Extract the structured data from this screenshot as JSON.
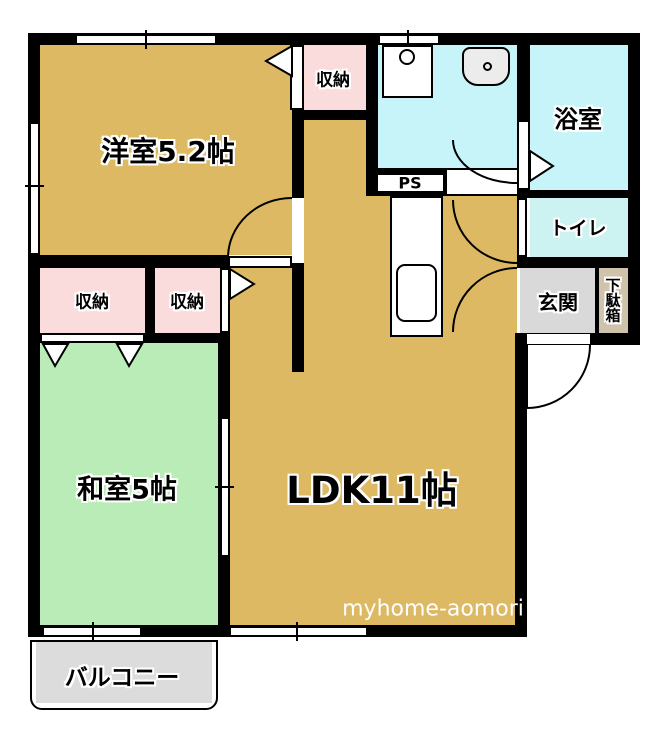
{
  "rooms": {
    "western_room": {
      "label": "洋室5.2帖"
    },
    "closet_top": {
      "label": "収納"
    },
    "washroom": {
      "label": ""
    },
    "bathroom": {
      "label": "浴室"
    },
    "toilet": {
      "label": "トイレ"
    },
    "pipe_space": {
      "label": "PS"
    },
    "closet_left": {
      "label": "収納"
    },
    "closet_right": {
      "label": "収納"
    },
    "japanese_room": {
      "label": "和室5帖"
    },
    "ldk": {
      "label": "LDK11帖"
    },
    "entrance": {
      "label": "玄関"
    },
    "shoe_cabinet": {
      "label": "下駄箱"
    },
    "balcony": {
      "label": "バルコニー"
    }
  },
  "watermark": "myhome-aomori",
  "fixtures": [
    "washing-machine-pan",
    "wash-basin",
    "kitchen-counter",
    "kitchen-sink"
  ],
  "colors": {
    "wall": "#000000",
    "western_room_floor": "#ddb963",
    "ldk_floor": "#ddb963",
    "japanese_room_floor": "#b9ecb6",
    "closet_floor": "#fbdcdc",
    "washroom_floor": "#c6f4f9",
    "bathroom_floor": "#c6f4f9",
    "toilet_floor": "#cdf2f2",
    "entrance_floor": "#d9d9d9",
    "shoe_cabinet_floor": "#cfc3ab",
    "balcony_floor": "#dcdcdc",
    "watermark_text": "#ffffff"
  }
}
